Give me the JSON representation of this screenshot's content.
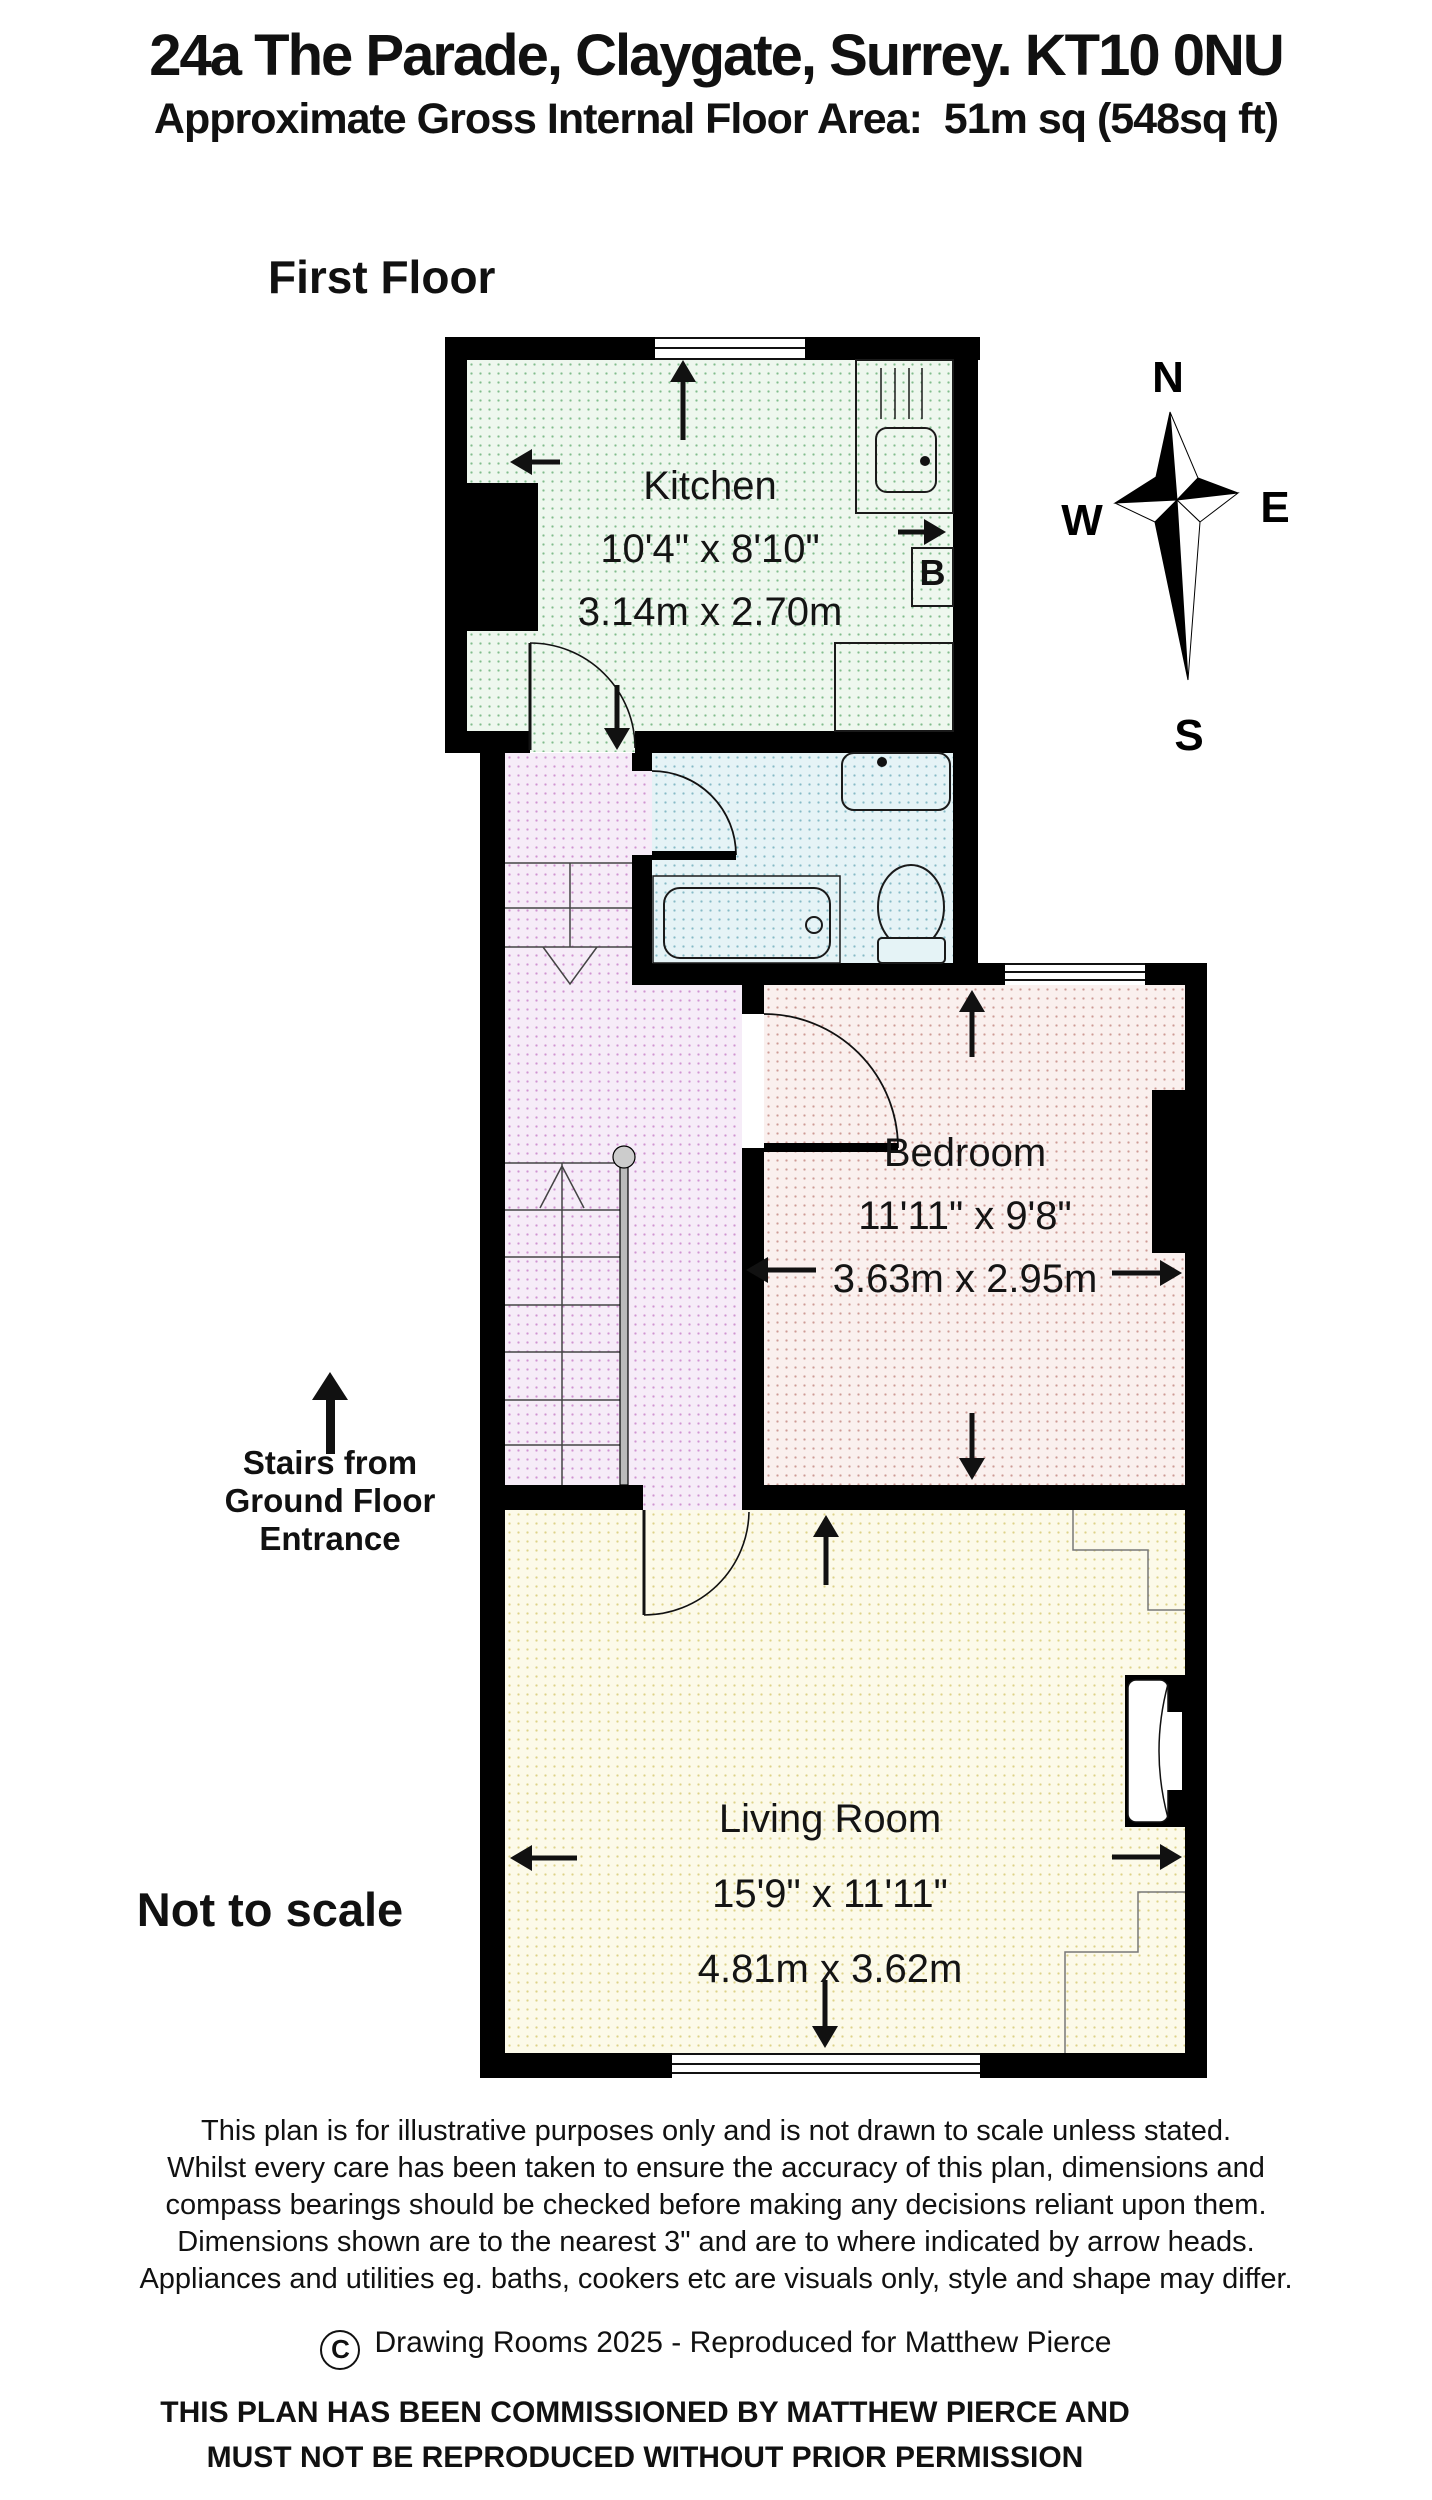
{
  "header": {
    "address": "24a The Parade, Claygate, Surrey. KT10 0NU",
    "area_line": "Approximate Gross Internal Floor Area:  51m sq (548sq ft)",
    "floor_label": "First Floor",
    "not_to_scale": "Not to scale"
  },
  "compass": {
    "n": "N",
    "e": "E",
    "s": "S",
    "w": "W"
  },
  "rooms": {
    "kitchen": {
      "name": "Kitchen",
      "imperial": "10'4\" x 8'10\"",
      "metric": "3.14m x 2.70m"
    },
    "bedroom": {
      "name": "Bedroom",
      "imperial": "11'11\" x 9'8\"",
      "metric": "3.63m x 2.95m"
    },
    "living": {
      "name": "Living Room",
      "imperial": "15'9\" x 11'11\"",
      "metric": "4.81m x 3.62m"
    }
  },
  "labels": {
    "boiler": "B",
    "stairs_note_line1": "Stairs from",
    "stairs_note_line2": "Ground Floor",
    "stairs_note_line3": "Entrance"
  },
  "footer": {
    "disclaimer_lines": [
      "This plan is for illustrative purposes only and is not drawn to scale unless stated.",
      "Whilst every care has been taken to ensure the accuracy of this plan, dimensions and",
      "compass bearings should be checked before making any decisions reliant upon them.",
      "Dimensions shown are to the nearest 3\" and are to where indicated by arrow heads.",
      "Appliances and utilities eg. baths, cookers etc are visuals only, style and shape may differ."
    ],
    "copyright_symbol": "C",
    "copyright_text": "Drawing Rooms 2025 - Reproduced for Matthew Pierce",
    "commission_line1": "THIS PLAN HAS BEEN COMMISSIONED BY MATTHEW PIERCE AND",
    "commission_line2": "MUST NOT BE REPRODUCED WITHOUT PRIOR PERMISSION"
  },
  "colors": {
    "wall": "#000000",
    "kitchen_fill": "#eef7ee",
    "bathroom_fill": "#e5f3f6",
    "landing_fill": "#f6ecf8",
    "bedroom_fill": "#faf0ee",
    "living_fill": "#fcfae9"
  }
}
